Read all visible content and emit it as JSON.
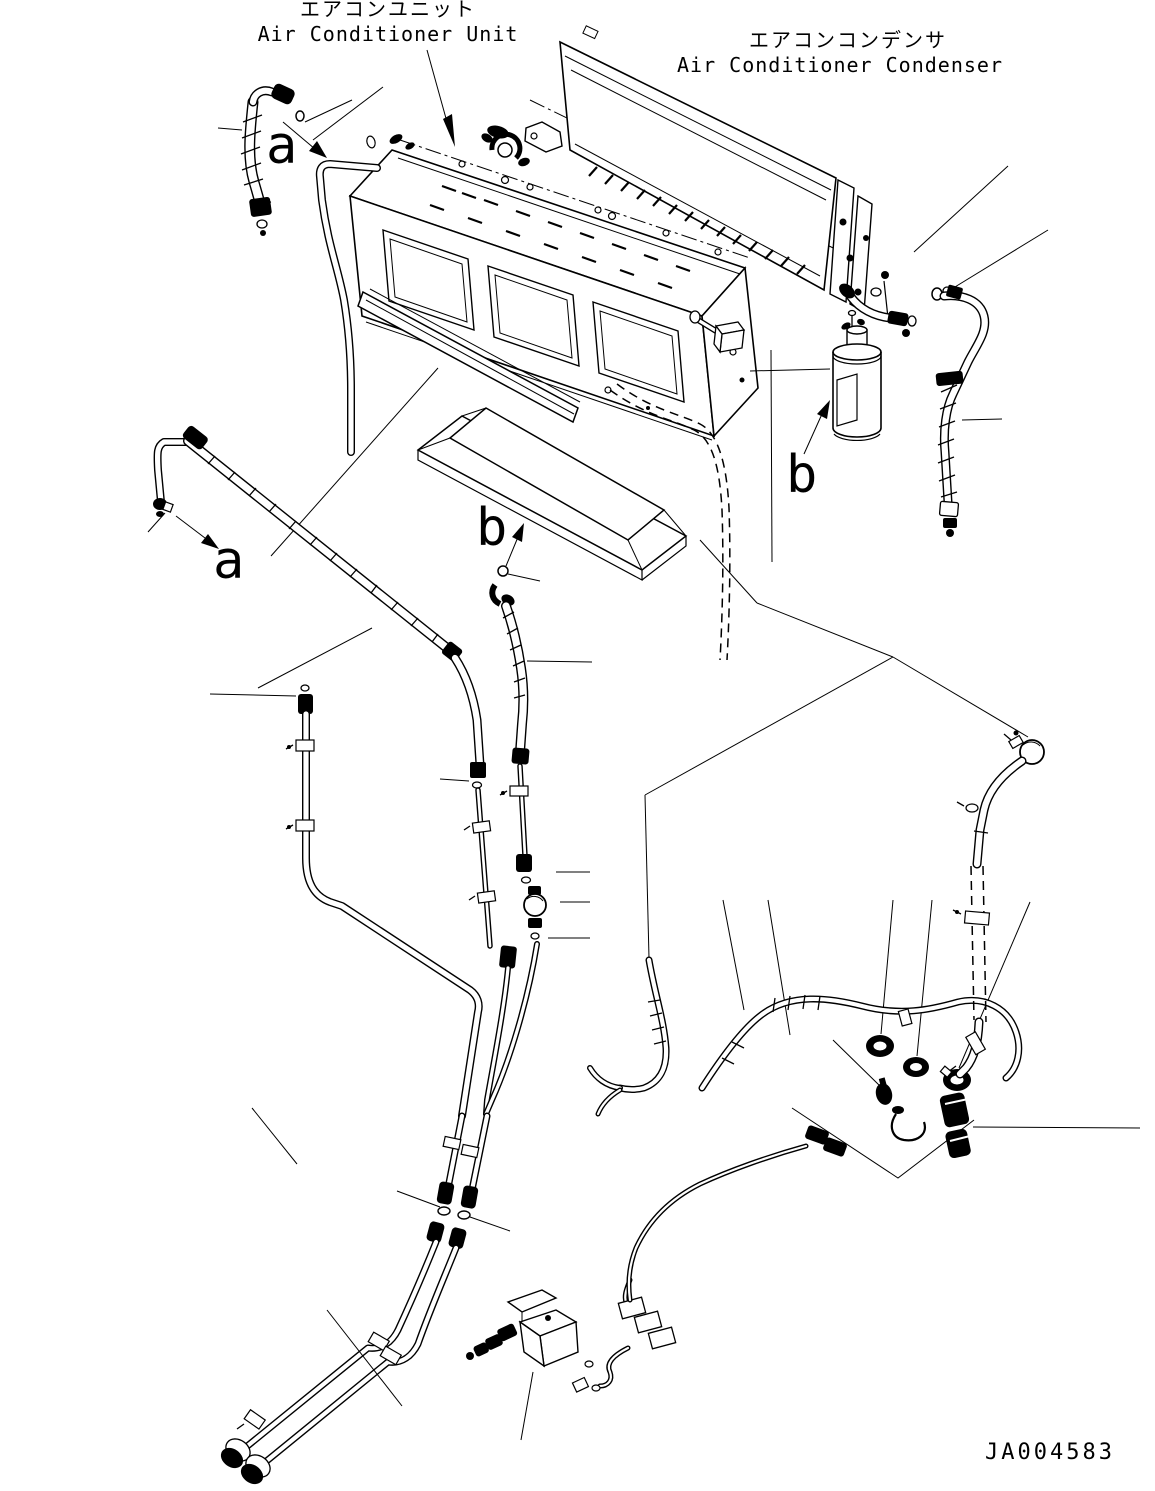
{
  "labels": {
    "unit_jp": "エアコンユニット",
    "unit_en": "Air Conditioner Unit",
    "condenser_jp": "エアコンコンデンサ",
    "condenser_en": "Air Conditioner Condenser"
  },
  "callouts": {
    "a_upper": "a",
    "a_left": "a",
    "b_center": "b",
    "b_right": "b"
  },
  "drawing_number": "JA004583",
  "colors": {
    "line": "#000000",
    "background": "#ffffff"
  }
}
